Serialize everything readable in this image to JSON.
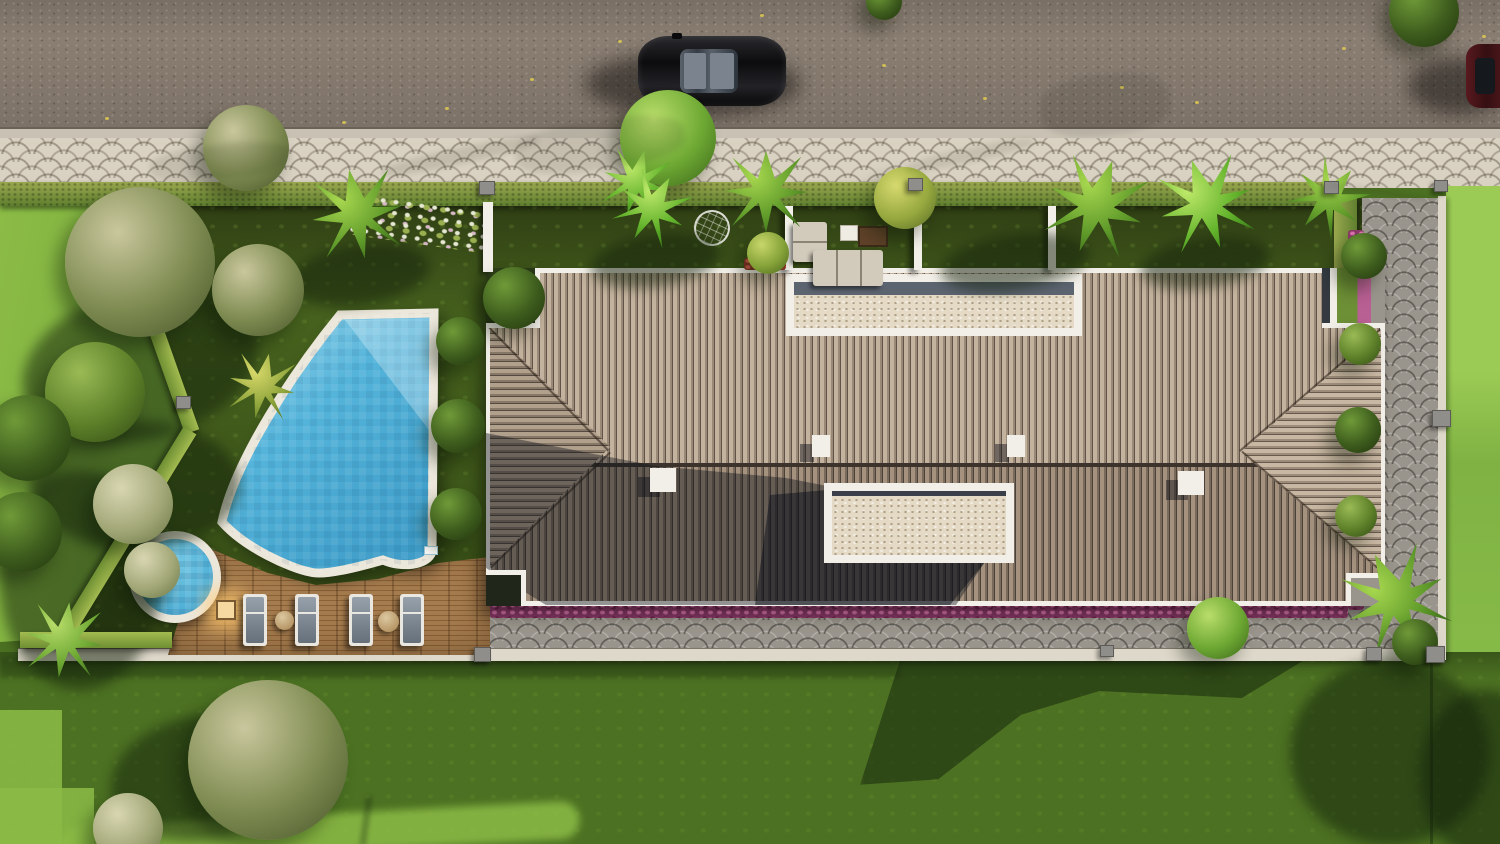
{
  "meta": {
    "title": "Top-down 3D architectural rendering of a modern villa",
    "view": "aerial plan view",
    "features": [
      "asphalt road with two cars",
      "scalloped cobblestone sidewalk",
      "hedged garden",
      "free-form swimming pool",
      "round plunge pool",
      "wooden sun deck with loungers",
      "hip tiled roof with two open courtyards",
      "flower borders",
      "lawns"
    ]
  },
  "palette": {
    "road": "#8a7e72",
    "curb": "#c9c2b4",
    "sidewalk": "#d9d1c1",
    "hedge1": "#9aa84e",
    "hedge2": "#5f7f2f",
    "hedgeBright": "#a3bb50",
    "grassInner1": "#46611e",
    "grassInner2": "#2e3d13",
    "lawnBright": "#8cbc46",
    "lawnMid": "#6fa438",
    "lawnBottom": "#4c7122",
    "lawnRight": "#8ec24c",
    "roofLight": "#c3b29d",
    "roofLightMid": "#9a8977",
    "roofGap": "#60544a",
    "roofDark": "#a4927f",
    "roofDarkMid": "#7a6a5c",
    "roofDarkGap": "#4a4138",
    "white": "#f2efe8",
    "gravel": "#e4dac6",
    "gravelBand": "#5c6470",
    "water": "#55b4da",
    "waterDeep": "#3f9dc8",
    "waterLight": "#aadcef",
    "coping": "#ece7db",
    "deck1": "#a57c4e",
    "deck2": "#8a6036",
    "magenta": "#8c3a68",
    "magentaDot": "#d973ab",
    "path": "#9a958c",
    "wall": "#ded8ca",
    "post": "#8f8e8a",
    "lamp": "#f5d9a0",
    "carBlack": "#111114",
    "carRed": "#4a171b"
  },
  "scene": {
    "treeColors": {
      "olive": [
        "#c9c79d",
        "#7d8a50",
        "#4c5a2e"
      ],
      "pale": [
        "#d8d6b2",
        "#a3a878",
        "#6f7a4a"
      ],
      "dark": [
        "#6f9a38",
        "#3d5c1d",
        "#24380f"
      ],
      "mid": [
        "#9aba55",
        "#5d8029",
        "#365016"
      ],
      "bright": [
        "#b9dd6a",
        "#6da833",
        "#3f6b1c"
      ],
      "bushYellow": [
        "#d6d96e",
        "#97a93f",
        "#5c7026"
      ],
      "palm": [
        "#a8d84f",
        "#5f9a2a",
        "#2f5a14"
      ],
      "palmYellow": [
        "#d9d96a",
        "#8fa53c",
        "#55701f"
      ],
      "banana": [
        "#bfe96a",
        "#63b32c",
        "#2f7114"
      ],
      "ball": [
        "#c8d66a",
        "#84a238",
        "#4e6a1f"
      ]
    },
    "trees": [
      {
        "type": "olive",
        "x": 246,
        "y": 148,
        "s": 86
      },
      {
        "type": "bright",
        "x": 668,
        "y": 138,
        "s": 96
      },
      {
        "type": "banana",
        "x": 636,
        "y": 182,
        "s": 66,
        "star": true,
        "rot": 15
      },
      {
        "type": "palm",
        "x": 766,
        "y": 192,
        "s": 82,
        "star": true
      },
      {
        "type": "bushYellow",
        "x": 905,
        "y": 198,
        "s": 62
      },
      {
        "type": "palm",
        "x": 1096,
        "y": 206,
        "s": 96,
        "star": true,
        "rot": 20
      },
      {
        "type": "banana",
        "x": 1206,
        "y": 204,
        "s": 92,
        "star": true,
        "rot": -18
      },
      {
        "type": "palm",
        "x": 1328,
        "y": 198,
        "s": 72,
        "star": true,
        "rot": 40
      },
      {
        "type": "dark",
        "x": 1424,
        "y": 12,
        "s": 70
      },
      {
        "type": "dark",
        "x": 884,
        "y": 2,
        "s": 36
      },
      {
        "type": "palm",
        "x": 357,
        "y": 214,
        "s": 90,
        "star": true,
        "rot": -10
      },
      {
        "type": "banana",
        "x": 652,
        "y": 208,
        "s": 70,
        "star": true,
        "rot": 30
      },
      {
        "type": "dark",
        "x": 514,
        "y": 298,
        "s": 62
      },
      {
        "type": "olive",
        "x": 258,
        "y": 290,
        "s": 92
      },
      {
        "type": "palmYellow",
        "x": 262,
        "y": 386,
        "s": 66,
        "star": true,
        "rot": 12
      },
      {
        "type": "dark",
        "x": 460,
        "y": 341,
        "s": 48
      },
      {
        "type": "dark",
        "x": 458,
        "y": 426,
        "s": 54
      },
      {
        "type": "dark",
        "x": 456,
        "y": 514,
        "s": 52
      },
      {
        "type": "ball",
        "x": 768,
        "y": 253,
        "s": 42
      },
      {
        "type": "olive",
        "x": 140,
        "y": 262,
        "s": 150
      },
      {
        "type": "mid",
        "x": 95,
        "y": 392,
        "s": 100
      },
      {
        "type": "dark",
        "x": 28,
        "y": 438,
        "s": 86
      },
      {
        "type": "pale",
        "x": 133,
        "y": 504,
        "s": 80
      },
      {
        "type": "dark",
        "x": 22,
        "y": 532,
        "s": 80
      },
      {
        "type": "bright",
        "x": 64,
        "y": 640,
        "s": 76,
        "star": true,
        "rot": 8
      },
      {
        "type": "pale",
        "x": 152,
        "y": 570,
        "s": 56
      },
      {
        "type": "palm",
        "x": 1396,
        "y": 600,
        "s": 100,
        "star": true,
        "rot": -25
      },
      {
        "type": "dark",
        "x": 1364,
        "y": 256,
        "s": 46
      },
      {
        "type": "mid",
        "x": 1360,
        "y": 344,
        "s": 42
      },
      {
        "type": "dark",
        "x": 1358,
        "y": 430,
        "s": 46
      },
      {
        "type": "mid",
        "x": 1356,
        "y": 516,
        "s": 42
      },
      {
        "type": "bright",
        "x": 1218,
        "y": 628,
        "s": 62
      },
      {
        "type": "dark",
        "x": 1415,
        "y": 642,
        "s": 46
      },
      {
        "type": "olive",
        "x": 268,
        "y": 760,
        "s": 160
      },
      {
        "type": "pale",
        "x": 128,
        "y": 828,
        "s": 70
      }
    ],
    "hedge_segments": [
      {
        "x": 112,
        "y": 198,
        "len": 240,
        "h": 15,
        "rot": 70.5
      },
      {
        "x": 190,
        "y": 423,
        "len": 246,
        "h": 15,
        "rot": 121.4
      },
      {
        "x": 20,
        "y": 632,
        "len": 152,
        "h": 16,
        "rot": 0
      }
    ],
    "loungers": {
      "xs": [
        243,
        295,
        349,
        400
      ],
      "y": 594
    },
    "tables": [
      {
        "x": 275,
        "y": 611,
        "d": 19
      },
      {
        "x": 378,
        "y": 611,
        "d": 21
      }
    ],
    "posts": [
      {
        "x": 479,
        "y": 181,
        "s": 14
      },
      {
        "x": 908,
        "y": 178,
        "s": 13
      },
      {
        "x": 1324,
        "y": 181,
        "s": 13
      },
      {
        "x": 176,
        "y": 396,
        "s": 13
      },
      {
        "x": 1432,
        "y": 410,
        "s": 17
      },
      {
        "x": 1426,
        "y": 646,
        "s": 17
      },
      {
        "x": 474,
        "y": 647,
        "s": 15
      },
      {
        "x": 1100,
        "y": 645,
        "s": 12
      },
      {
        "x": 1366,
        "y": 647,
        "s": 14
      },
      {
        "x": 1434,
        "y": 180,
        "s": 12
      }
    ],
    "specks": [
      {
        "x": 105,
        "y": 117
      },
      {
        "x": 342,
        "y": 121
      },
      {
        "x": 445,
        "y": 107
      },
      {
        "x": 618,
        "y": 40
      },
      {
        "x": 760,
        "y": 14
      },
      {
        "x": 983,
        "y": 97
      },
      {
        "x": 1120,
        "y": 86
      },
      {
        "x": 1195,
        "y": 101
      },
      {
        "x": 1342,
        "y": 47
      },
      {
        "x": 1482,
        "y": 35
      },
      {
        "x": 882,
        "y": 64
      },
      {
        "x": 530,
        "y": 78
      }
    ],
    "streaks": [
      {
        "x": 380,
        "y": 148,
        "w": 160,
        "h": 16,
        "rot": -12,
        "o": 0.35
      },
      {
        "x": 905,
        "y": 148,
        "w": 130,
        "h": 14,
        "rot": -12,
        "o": 0.3
      },
      {
        "x": 515,
        "y": 120,
        "w": 170,
        "h": 50,
        "rot": -8,
        "o": 0.3
      },
      {
        "x": 1040,
        "y": 75,
        "w": 130,
        "h": 60,
        "rot": -6,
        "o": 0.3
      },
      {
        "x": 150,
        "y": 145,
        "w": 140,
        "h": 34,
        "rot": -6,
        "o": 0.3
      },
      {
        "x": 1326,
        "y": 190,
        "w": 112,
        "h": 5,
        "rot": 8,
        "o": 0.35
      }
    ],
    "garden_shades": [
      {
        "x": 20,
        "y": 290,
        "w": 240,
        "h": 150,
        "rot": -15
      },
      {
        "x": 30,
        "y": 420,
        "w": 210,
        "h": 130,
        "rot": 0
      },
      {
        "x": 0,
        "y": 470,
        "w": 160,
        "h": 220,
        "rot": 0
      },
      {
        "x": 290,
        "y": 245,
        "w": 140,
        "h": 60,
        "rot": -8
      },
      {
        "x": 590,
        "y": 235,
        "w": 130,
        "h": 52,
        "rot": -8
      },
      {
        "x": 940,
        "y": 235,
        "w": 150,
        "h": 55,
        "rot": -8
      },
      {
        "x": 1140,
        "y": 238,
        "w": 130,
        "h": 50,
        "rot": -8
      },
      {
        "x": 110,
        "y": 715,
        "w": 190,
        "h": 125,
        "rot": -10
      },
      {
        "x": 1290,
        "y": 660,
        "w": 200,
        "h": 185,
        "rot": 0
      },
      {
        "x": 1420,
        "y": 690,
        "w": 130,
        "h": 170,
        "rot": 0
      }
    ]
  }
}
